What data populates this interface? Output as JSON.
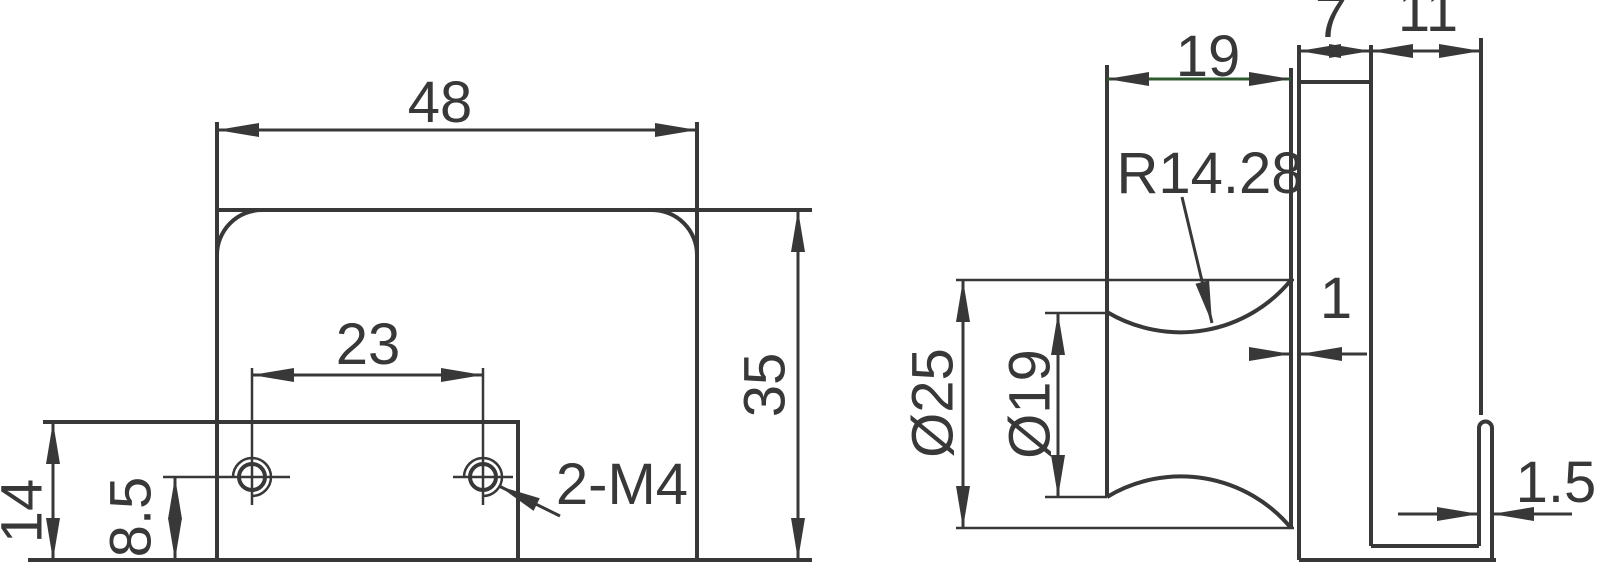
{
  "drawing": {
    "type": "technical-dimension-drawing",
    "colors": {
      "background": "#ffffff",
      "line": "#383838",
      "knob_length_dim_line": "#2f5a2f"
    },
    "front_view": {
      "width_label": "48",
      "hole_spacing_label": "23",
      "height_label": "35",
      "step_height_label": "14",
      "hole_offset_label": "8.5",
      "thread_label": "2-M4",
      "hole_count": 2
    },
    "side_view": {
      "knob_length_label": "19",
      "plate_thickness_label": "7",
      "depth_label": "11",
      "outer_diameter_label": "Ø25",
      "waist_diameter_label": "Ø19",
      "radius_label": "R14.28",
      "clearance_label": "1",
      "slot_label": "1.5"
    }
  }
}
